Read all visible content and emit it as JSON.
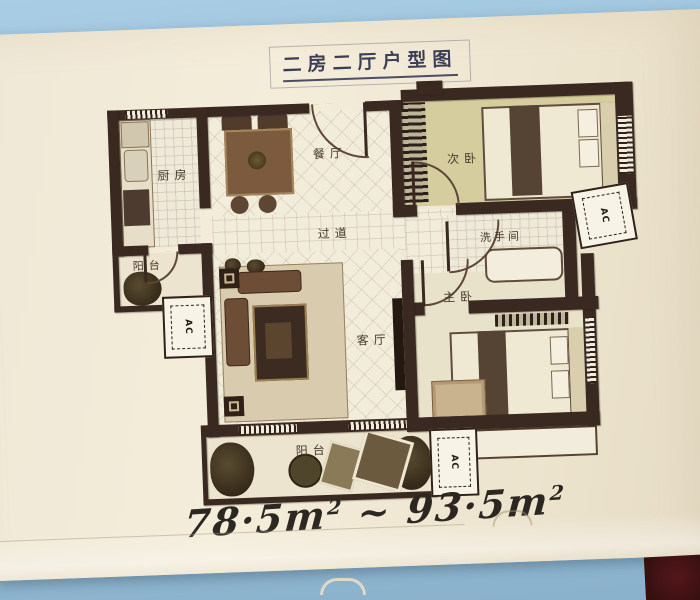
{
  "title": "二房二厅户型图",
  "plan": {
    "rooms": {
      "kitchen": "厨房",
      "dining": "餐厅",
      "second_bedroom": "次卧",
      "hallway": "过道",
      "bathroom": "洗手间",
      "master_bedroom": "主卧",
      "living_room": "客厅",
      "balcony_left": "阳台",
      "balcony_bottom": "阳台"
    },
    "ac_label": "AC"
  },
  "area_note": {
    "min": "78·5m",
    "min_sup": "2",
    "separator": "~",
    "max": "93·5m",
    "max_sup": "2"
  },
  "colors": {
    "background_blue": "#a4c9e1",
    "paper_cream": "#f0e9d7",
    "wall_dark": "#3a2921",
    "bedroom_floor_khaki": "#d6cd9e",
    "title_ink": "#3c3e55",
    "handwriting_ink": "#2c2721"
  }
}
